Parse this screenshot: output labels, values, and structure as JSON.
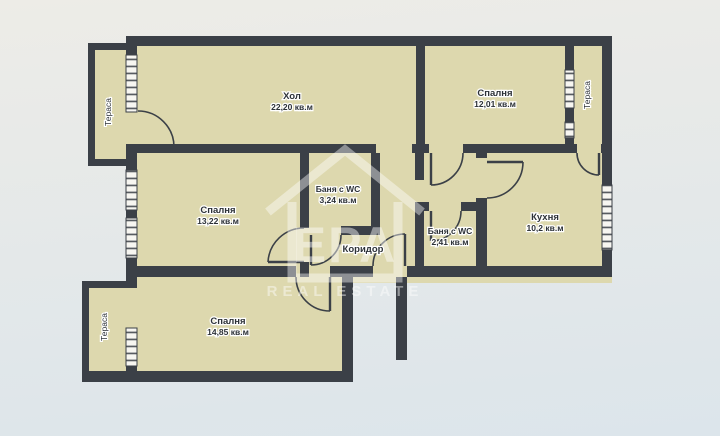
{
  "palette": {
    "background_top": "#edece7",
    "background_bottom": "#dce5eb",
    "room_fill": "#ddd8ae",
    "wall_color": "#3b4047",
    "window_fill": "#f7f6f1",
    "label_color": "#2c3137",
    "watermark_color": "#ffffff"
  },
  "watermark": {
    "brand": "ЕРА",
    "tagline": "REAL ESTATE"
  },
  "rooms": [
    {
      "id": "living",
      "name": "Хол",
      "area": "22,20 кв.м"
    },
    {
      "id": "bedroom-top",
      "name": "Спалня",
      "area": "12,01 кв.м"
    },
    {
      "id": "terrace-right",
      "name": "Тераса",
      "area": ""
    },
    {
      "id": "terrace-left-top",
      "name": "Тераса",
      "area": ""
    },
    {
      "id": "bedroom-left",
      "name": "Спалня",
      "area": "13,22 кв.м"
    },
    {
      "id": "bath-large",
      "name": "Баня с WC",
      "area": "3,24 кв.м"
    },
    {
      "id": "corridor",
      "name": "Коридор",
      "area": ""
    },
    {
      "id": "bath-small",
      "name": "Баня с WC",
      "area": "2,41 кв.м"
    },
    {
      "id": "kitchen",
      "name": "Кухня",
      "area": "10,2 кв.м"
    },
    {
      "id": "bedroom-bottom",
      "name": "Спалня",
      "area": "14,85 кв.м"
    },
    {
      "id": "terrace-left-bottom",
      "name": "Тераса",
      "area": ""
    }
  ]
}
